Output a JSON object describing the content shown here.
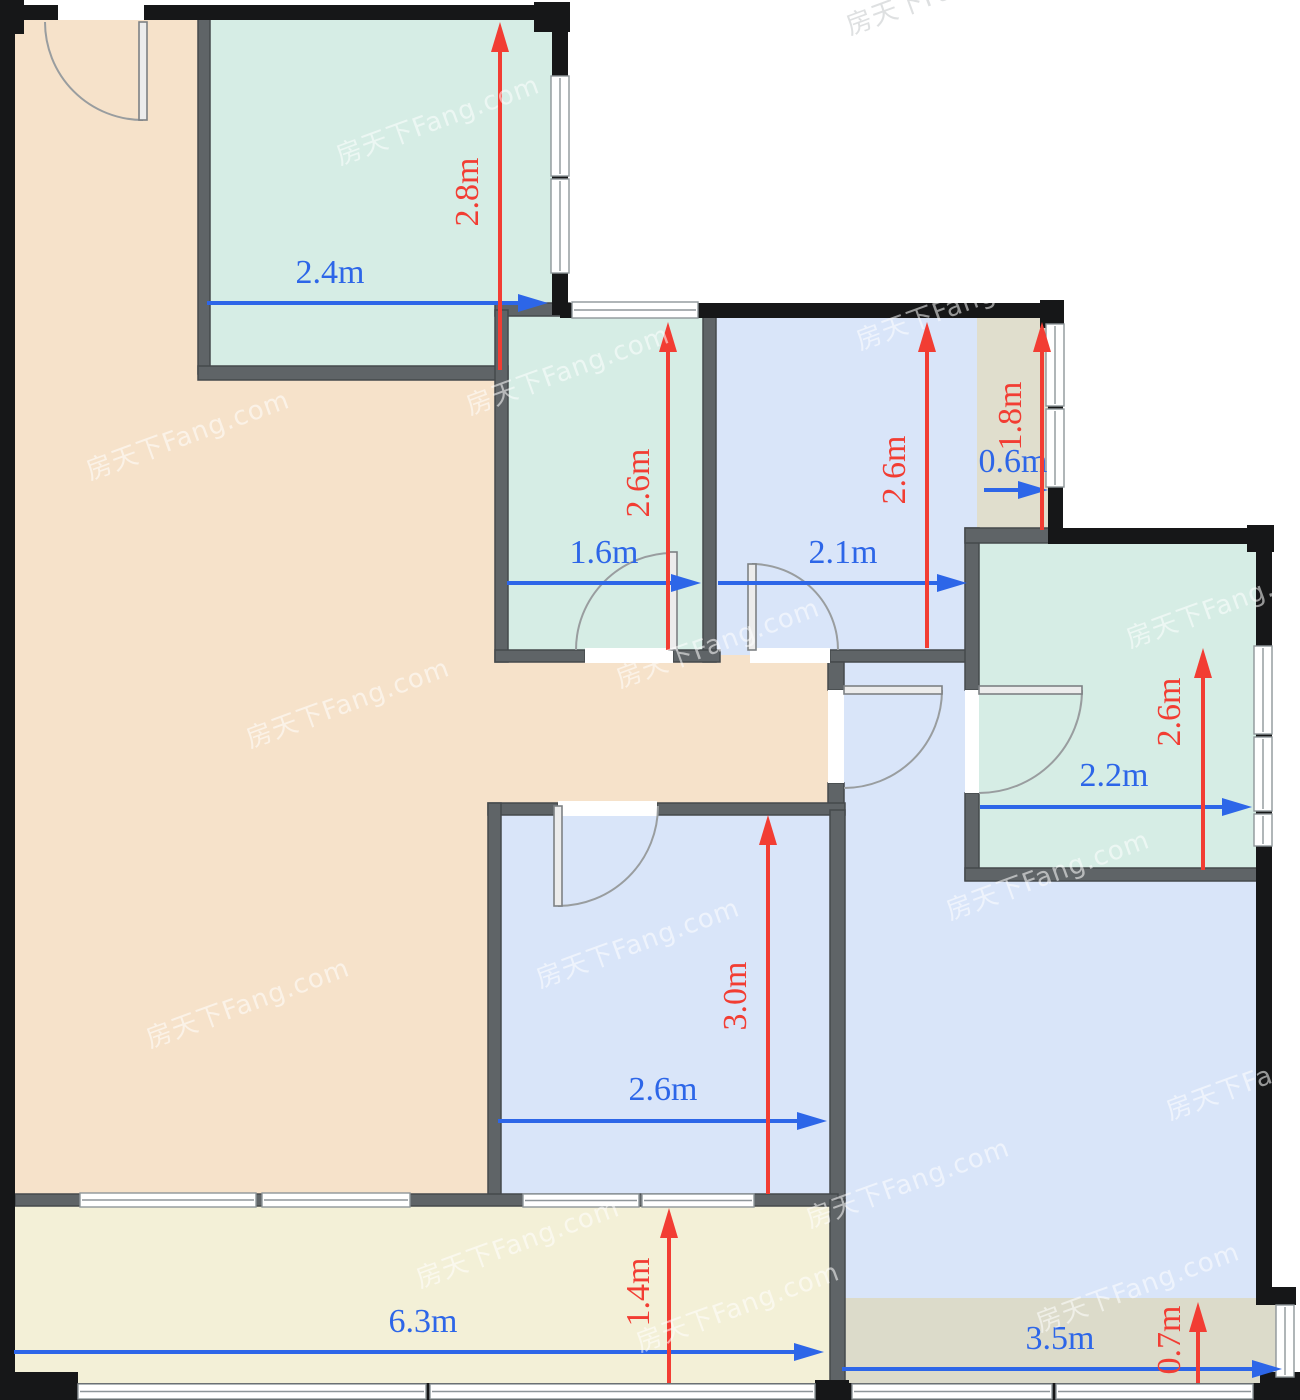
{
  "plan_title": "apartment-floor-plan",
  "canvas": {
    "width": 1300,
    "height": 1400
  },
  "colors": {
    "background": "#ffffff",
    "wall_exterior": "#161718",
    "wall_interior": "#5f6467",
    "wall_interior_stroke": "#45494c",
    "window_fill": "#ffffff",
    "window_line": "#8f969a",
    "door_line": "#999d9f",
    "door_leaf_fill": "#ececec",
    "dim_blue": "#2d66e8",
    "dim_red": "#f23d33",
    "living": "#f6e2ca",
    "teal_room": "#d6ede5",
    "blue_room": "#d9e5f9",
    "olive_bay": "#e0decd",
    "olive_bottom": "#dcdbca",
    "balcony": "#f3f0d7",
    "watermark_light": "rgba(255,255,255,0.55)",
    "watermark_gray": "rgba(195,198,201,0.55)"
  },
  "watermark": {
    "text": "房天下Fang.com",
    "rotation": -20,
    "font_size": 26,
    "positions": [
      {
        "x": 340,
        "y": 165,
        "tone": "light"
      },
      {
        "x": 850,
        "y": 35,
        "tone": "gray"
      },
      {
        "x": 90,
        "y": 480,
        "tone": "light"
      },
      {
        "x": 470,
        "y": 415,
        "tone": "light"
      },
      {
        "x": 860,
        "y": 350,
        "tone": "light"
      },
      {
        "x": 250,
        "y": 748,
        "tone": "light"
      },
      {
        "x": 620,
        "y": 688,
        "tone": "light"
      },
      {
        "x": 1130,
        "y": 648,
        "tone": "light"
      },
      {
        "x": 150,
        "y": 1048,
        "tone": "light"
      },
      {
        "x": 540,
        "y": 988,
        "tone": "light"
      },
      {
        "x": 950,
        "y": 920,
        "tone": "light"
      },
      {
        "x": 420,
        "y": 1288,
        "tone": "light"
      },
      {
        "x": 810,
        "y": 1228,
        "tone": "light"
      },
      {
        "x": 1170,
        "y": 1120,
        "tone": "light"
      },
      {
        "x": 640,
        "y": 1352,
        "tone": "light"
      },
      {
        "x": 1040,
        "y": 1332,
        "tone": "light"
      }
    ]
  },
  "rooms": [
    {
      "name": "living-room-left",
      "fill": "living",
      "rect": [
        15,
        20,
        185,
        1176
      ]
    },
    {
      "name": "living-room-mid",
      "fill": "living",
      "rect": [
        200,
        370,
        295,
        826
      ]
    },
    {
      "name": "living-room-strip",
      "fill": "living",
      "rect": [
        495,
        655,
        340,
        150
      ]
    },
    {
      "name": "main-blue-area",
      "fill": "blue_room",
      "rect": [
        838,
        655,
        419,
        645
      ]
    },
    {
      "name": "bedroom-top-left",
      "fill": "teal_room",
      "rect": [
        207,
        20,
        348,
        350
      ]
    },
    {
      "name": "study-room",
      "fill": "teal_room",
      "rect": [
        503,
        310,
        210,
        345
      ]
    },
    {
      "name": "bedroom-top-mid",
      "fill": "blue_room",
      "rect": [
        713,
        315,
        264,
        340
      ]
    },
    {
      "name": "bay-top-right",
      "fill": "olive_bay",
      "rect": [
        977,
        315,
        75,
        220
      ]
    },
    {
      "name": "bedroom-right",
      "fill": "teal_room",
      "rect": [
        975,
        540,
        282,
        332
      ]
    },
    {
      "name": "bedroom-center",
      "fill": "blue_room",
      "rect": [
        495,
        808,
        340,
        390
      ]
    },
    {
      "name": "bay-bottom-right",
      "fill": "olive_bottom",
      "rect": [
        838,
        1298,
        438,
        87
      ]
    },
    {
      "name": "balcony",
      "fill": "balcony",
      "rect": [
        15,
        1200,
        818,
        185
      ]
    }
  ],
  "walls": {
    "exterior": [
      [
        0,
        5,
        570,
        15
      ],
      [
        0,
        0,
        24,
        34
      ],
      [
        534,
        2,
        36,
        30
      ],
      [
        552,
        18,
        16,
        297
      ],
      [
        560,
        303,
        503,
        15
      ],
      [
        1040,
        300,
        24,
        28
      ],
      [
        1048,
        316,
        15,
        214
      ],
      [
        1048,
        528,
        224,
        16
      ],
      [
        1247,
        525,
        27,
        27
      ],
      [
        1256,
        540,
        16,
        763
      ],
      [
        1256,
        1287,
        40,
        18
      ],
      [
        0,
        1383,
        1300,
        17
      ],
      [
        0,
        5,
        15,
        1395
      ],
      [
        0,
        1372,
        78,
        28
      ],
      [
        1260,
        1372,
        40,
        28
      ],
      [
        815,
        1380,
        34,
        20
      ]
    ],
    "interior": [
      [
        198,
        18,
        12,
        356
      ],
      [
        198,
        366,
        310,
        14
      ],
      [
        495,
        303,
        75,
        13
      ],
      [
        495,
        310,
        13,
        352
      ],
      [
        703,
        315,
        13,
        347
      ],
      [
        495,
        650,
        90,
        12
      ],
      [
        673,
        650,
        47,
        12
      ],
      [
        830,
        650,
        147,
        12
      ],
      [
        828,
        662,
        16,
        28
      ],
      [
        828,
        783,
        16,
        27
      ],
      [
        488,
        803,
        70,
        12
      ],
      [
        657,
        803,
        188,
        12
      ],
      [
        488,
        803,
        13,
        400
      ],
      [
        830,
        810,
        15,
        390
      ],
      [
        15,
        1194,
        823,
        12
      ],
      [
        830,
        1200,
        15,
        190
      ],
      [
        965,
        528,
        14,
        162
      ],
      [
        965,
        793,
        14,
        87
      ],
      [
        965,
        528,
        90,
        15
      ],
      [
        965,
        868,
        292,
        13
      ]
    ]
  },
  "windows": [
    {
      "rect": [
        551,
        76,
        18,
        100
      ],
      "orient": "v"
    },
    {
      "rect": [
        551,
        179,
        18,
        94
      ],
      "orient": "v"
    },
    {
      "rect": [
        572,
        302,
        126,
        16
      ],
      "orient": "h"
    },
    {
      "rect": [
        1046,
        324,
        18,
        82
      ],
      "orient": "v"
    },
    {
      "rect": [
        1046,
        409,
        18,
        78
      ],
      "orient": "v"
    },
    {
      "rect": [
        1254,
        646,
        18,
        88
      ],
      "orient": "v"
    },
    {
      "rect": [
        1254,
        737,
        18,
        74
      ],
      "orient": "v"
    },
    {
      "rect": [
        1254,
        814,
        18,
        32
      ],
      "orient": "v"
    },
    {
      "rect": [
        1276,
        1305,
        18,
        72
      ],
      "orient": "v"
    },
    {
      "rect": [
        80,
        1193,
        176,
        14
      ],
      "orient": "h"
    },
    {
      "rect": [
        262,
        1193,
        148,
        14
      ],
      "orient": "h"
    },
    {
      "rect": [
        523,
        1194,
        116,
        13
      ],
      "orient": "h"
    },
    {
      "rect": [
        642,
        1194,
        112,
        13
      ],
      "orient": "h"
    },
    {
      "rect": [
        78,
        1384,
        348,
        15
      ],
      "orient": "h"
    },
    {
      "rect": [
        430,
        1384,
        385,
        15
      ],
      "orient": "h"
    },
    {
      "rect": [
        852,
        1384,
        200,
        15
      ],
      "orient": "h"
    },
    {
      "rect": [
        1056,
        1384,
        197,
        15
      ],
      "orient": "h"
    }
  ],
  "openings": [
    [
      58,
      2,
      86,
      18
    ],
    [
      585,
      648,
      88,
      15
    ],
    [
      750,
      648,
      80,
      15
    ],
    [
      828,
      690,
      16,
      93
    ],
    [
      965,
      690,
      14,
      103
    ],
    [
      558,
      801,
      99,
      15
    ]
  ],
  "doors": [
    {
      "name": "entry-door",
      "leaf": [
        139,
        22,
        8,
        98
      ],
      "arc": "M 143 120 A 98 98 0 0 1 45 22"
    },
    {
      "name": "study-door",
      "leaf": [
        669,
        552,
        8,
        98
      ],
      "arc": "M 673 553 A 97 97 0 0 0 576 650"
    },
    {
      "name": "bedroom-mid-door",
      "leaf": [
        748,
        564,
        8,
        86
      ],
      "arc": "M 752 564 A 86 86 0 0 1 838 650"
    },
    {
      "name": "hallway-door",
      "leaf": [
        844,
        686,
        98,
        8
      ],
      "arc": "M 942 690 A 98 98 0 0 1 844 788"
    },
    {
      "name": "bedroom-right-door",
      "leaf": [
        979,
        686,
        103,
        8
      ],
      "arc": "M 1082 690 A 103 103 0 0 1 979 793"
    },
    {
      "name": "bedroom-center-door",
      "leaf": [
        554,
        806,
        8,
        100
      ],
      "arc": "M 558 906 A 100 100 0 0 0 658 806"
    }
  ],
  "dimension_font_size": 34,
  "dimensions": [
    {
      "label": "2.4m",
      "color": "blue",
      "from": [
        207,
        303
      ],
      "to": [
        548,
        303
      ],
      "label_pos": [
        330,
        283
      ],
      "rotated": false
    },
    {
      "label": "1.6m",
      "color": "blue",
      "from": [
        507,
        583
      ],
      "to": [
        701,
        583
      ],
      "label_pos": [
        604,
        563
      ],
      "rotated": false
    },
    {
      "label": "2.1m",
      "color": "blue",
      "from": [
        718,
        583
      ],
      "to": [
        967,
        583
      ],
      "label_pos": [
        843,
        563
      ],
      "rotated": false
    },
    {
      "label": "0.6m",
      "color": "blue",
      "from": [
        984,
        490
      ],
      "to": [
        1048,
        490
      ],
      "label_pos": [
        1013,
        472
      ],
      "rotated": false
    },
    {
      "label": "2.2m",
      "color": "blue",
      "from": [
        980,
        807
      ],
      "to": [
        1252,
        807
      ],
      "label_pos": [
        1114,
        786
      ],
      "rotated": false
    },
    {
      "label": "2.6m",
      "color": "blue",
      "from": [
        498,
        1121
      ],
      "to": [
        827,
        1121
      ],
      "label_pos": [
        663,
        1100
      ],
      "rotated": false
    },
    {
      "label": "6.3m",
      "color": "blue",
      "from": [
        14,
        1352
      ],
      "to": [
        824,
        1352
      ],
      "label_pos": [
        423,
        1332
      ],
      "rotated": false
    },
    {
      "label": "3.5m",
      "color": "blue",
      "from": [
        842,
        1369
      ],
      "to": [
        1282,
        1369
      ],
      "label_pos": [
        1060,
        1349
      ],
      "rotated": false
    },
    {
      "label": "2.8m",
      "color": "red",
      "from": [
        500,
        370
      ],
      "to": [
        500,
        22
      ],
      "label_pos": [
        478,
        192
      ],
      "rotated": true
    },
    {
      "label": "2.6m",
      "color": "red",
      "from": [
        668,
        650
      ],
      "to": [
        668,
        322
      ],
      "label_pos": [
        649,
        483
      ],
      "rotated": true
    },
    {
      "label": "2.6m",
      "color": "red",
      "from": [
        927,
        648
      ],
      "to": [
        927,
        322
      ],
      "label_pos": [
        905,
        470
      ],
      "rotated": true
    },
    {
      "label": "1.8m",
      "color": "red",
      "from": [
        1042,
        530
      ],
      "to": [
        1042,
        322
      ],
      "label_pos": [
        1021,
        416
      ],
      "rotated": true
    },
    {
      "label": "2.6m",
      "color": "red",
      "from": [
        1203,
        870
      ],
      "to": [
        1203,
        648
      ],
      "label_pos": [
        1180,
        712
      ],
      "rotated": true
    },
    {
      "label": "3.0m",
      "color": "red",
      "from": [
        768,
        1194
      ],
      "to": [
        768,
        815
      ],
      "label_pos": [
        746,
        996
      ],
      "rotated": true
    },
    {
      "label": "1.4m",
      "color": "red",
      "from": [
        669,
        1383
      ],
      "to": [
        669,
        1208
      ],
      "label_pos": [
        649,
        1292
      ],
      "rotated": true
    },
    {
      "label": "0.7m",
      "color": "red",
      "from": [
        1198,
        1383
      ],
      "to": [
        1198,
        1302
      ],
      "label_pos": [
        1180,
        1340
      ],
      "rotated": true
    }
  ]
}
